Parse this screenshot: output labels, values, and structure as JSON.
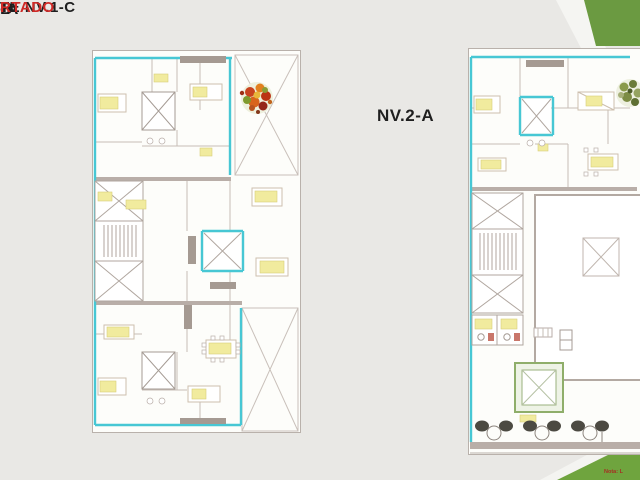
{
  "colors": {
    "background": "#e9e8e5",
    "sheet_white": "#fdfdfa",
    "wall_cyan": "#47c7d4",
    "wall_gray": "#b0a69f",
    "slab_gray": "#b9aea8",
    "furniture_yellow": "#f1eb9e",
    "corner_green_top": "#6b9a41",
    "corner_green_bottom": "#6fa43e",
    "label_black": "#1f1f1f",
    "label_red": "#cf2a27",
    "note_red": "#a62f22"
  },
  "labels": {
    "fragment_a": "-A",
    "fragment_b": "B",
    "nv1c_line1": "TE NV.1-C",
    "nv1c_line2": "RTADO",
    "nv2_title": "NV.2-A",
    "corner_note": "Nota: L"
  },
  "icons": {
    "tree_symbol": "tree-plan-icon",
    "elevator_shaft": "elevator-shaft-icon",
    "staircase": "staircase-icon",
    "terrace_cross": "crossed-void-icon"
  }
}
